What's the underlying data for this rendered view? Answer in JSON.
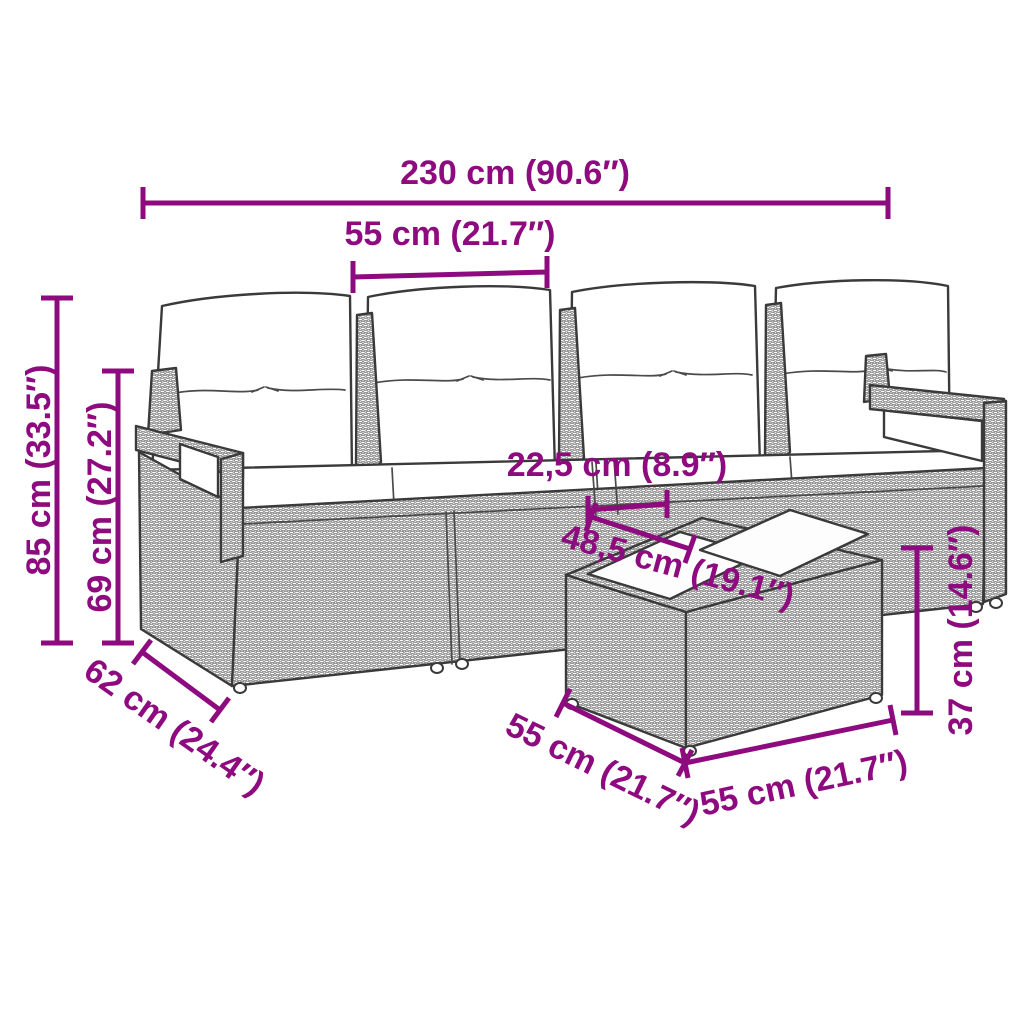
{
  "diagram": {
    "background_color": "#ffffff",
    "accent_color": "#8E0B7F",
    "outline_color": "#3a3a3a",
    "dimensions": [
      {
        "id": "overall-width",
        "label": "230 cm (90.6″)"
      },
      {
        "id": "seat-width",
        "label": "55 cm (21.7″)"
      },
      {
        "id": "overall-height",
        "label": "85 cm (33.5″)"
      },
      {
        "id": "seat-back-height",
        "label": "69 cm (27.2″)"
      },
      {
        "id": "module-gap",
        "label": "22,5 cm (8.9″)"
      },
      {
        "id": "table-diagonal",
        "label": "48,5 cm (19.1″)"
      },
      {
        "id": "sofa-depth",
        "label": "62 cm (24.4″)"
      },
      {
        "id": "table-depth",
        "label": "55 cm (21.7″)"
      },
      {
        "id": "table-width",
        "label": "55 cm (21.7″)"
      },
      {
        "id": "table-height",
        "label": "37 cm (14.6″)"
      }
    ]
  }
}
